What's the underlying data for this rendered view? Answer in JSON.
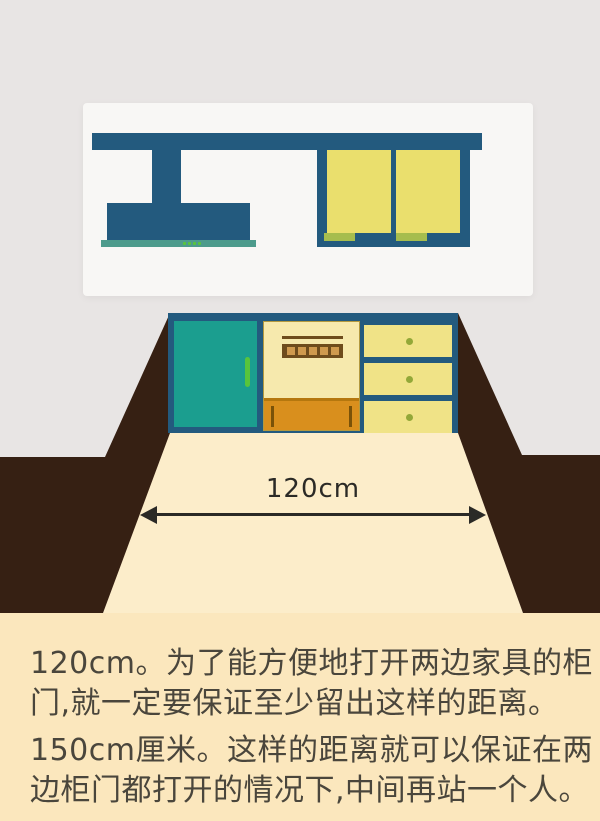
{
  "illustration": {
    "dimension_label": "120cm",
    "colors": {
      "background_gray": "#e8e5e4",
      "panel_white": "#f8f7f5",
      "cabinet_blue": "#235a7e",
      "hood_strip_teal": "#4d9b8c",
      "indicator_green": "#58c43c",
      "door_yellow": "#eadf6d",
      "handle_green": "#a6bd4e",
      "door_teal": "#1b9e8f",
      "drawer_yellow": "#f0e387",
      "knob_green": "#93a838",
      "appliance_cream": "#f6e9ad",
      "appliance_panel_brown": "#6e4c1c",
      "oven_button_tan": "#cf9a4e",
      "oven_drawer_orange": "#d98f1d",
      "wall_brown": "#362013",
      "floor_cream": "#fcedca",
      "arrow_dark": "#2b2a26"
    }
  },
  "caption": {
    "background": "#fbe7bd",
    "text_color": "#4a463c",
    "lines": [
      "120cm。为了能方便地打开两边家具的柜",
      "门,就一定要保证至少留出这样的距离。",
      "150cm厘米。这样的距离就可以保证在两",
      "边柜门都打开的情况下,中间再站一个人。"
    ]
  }
}
